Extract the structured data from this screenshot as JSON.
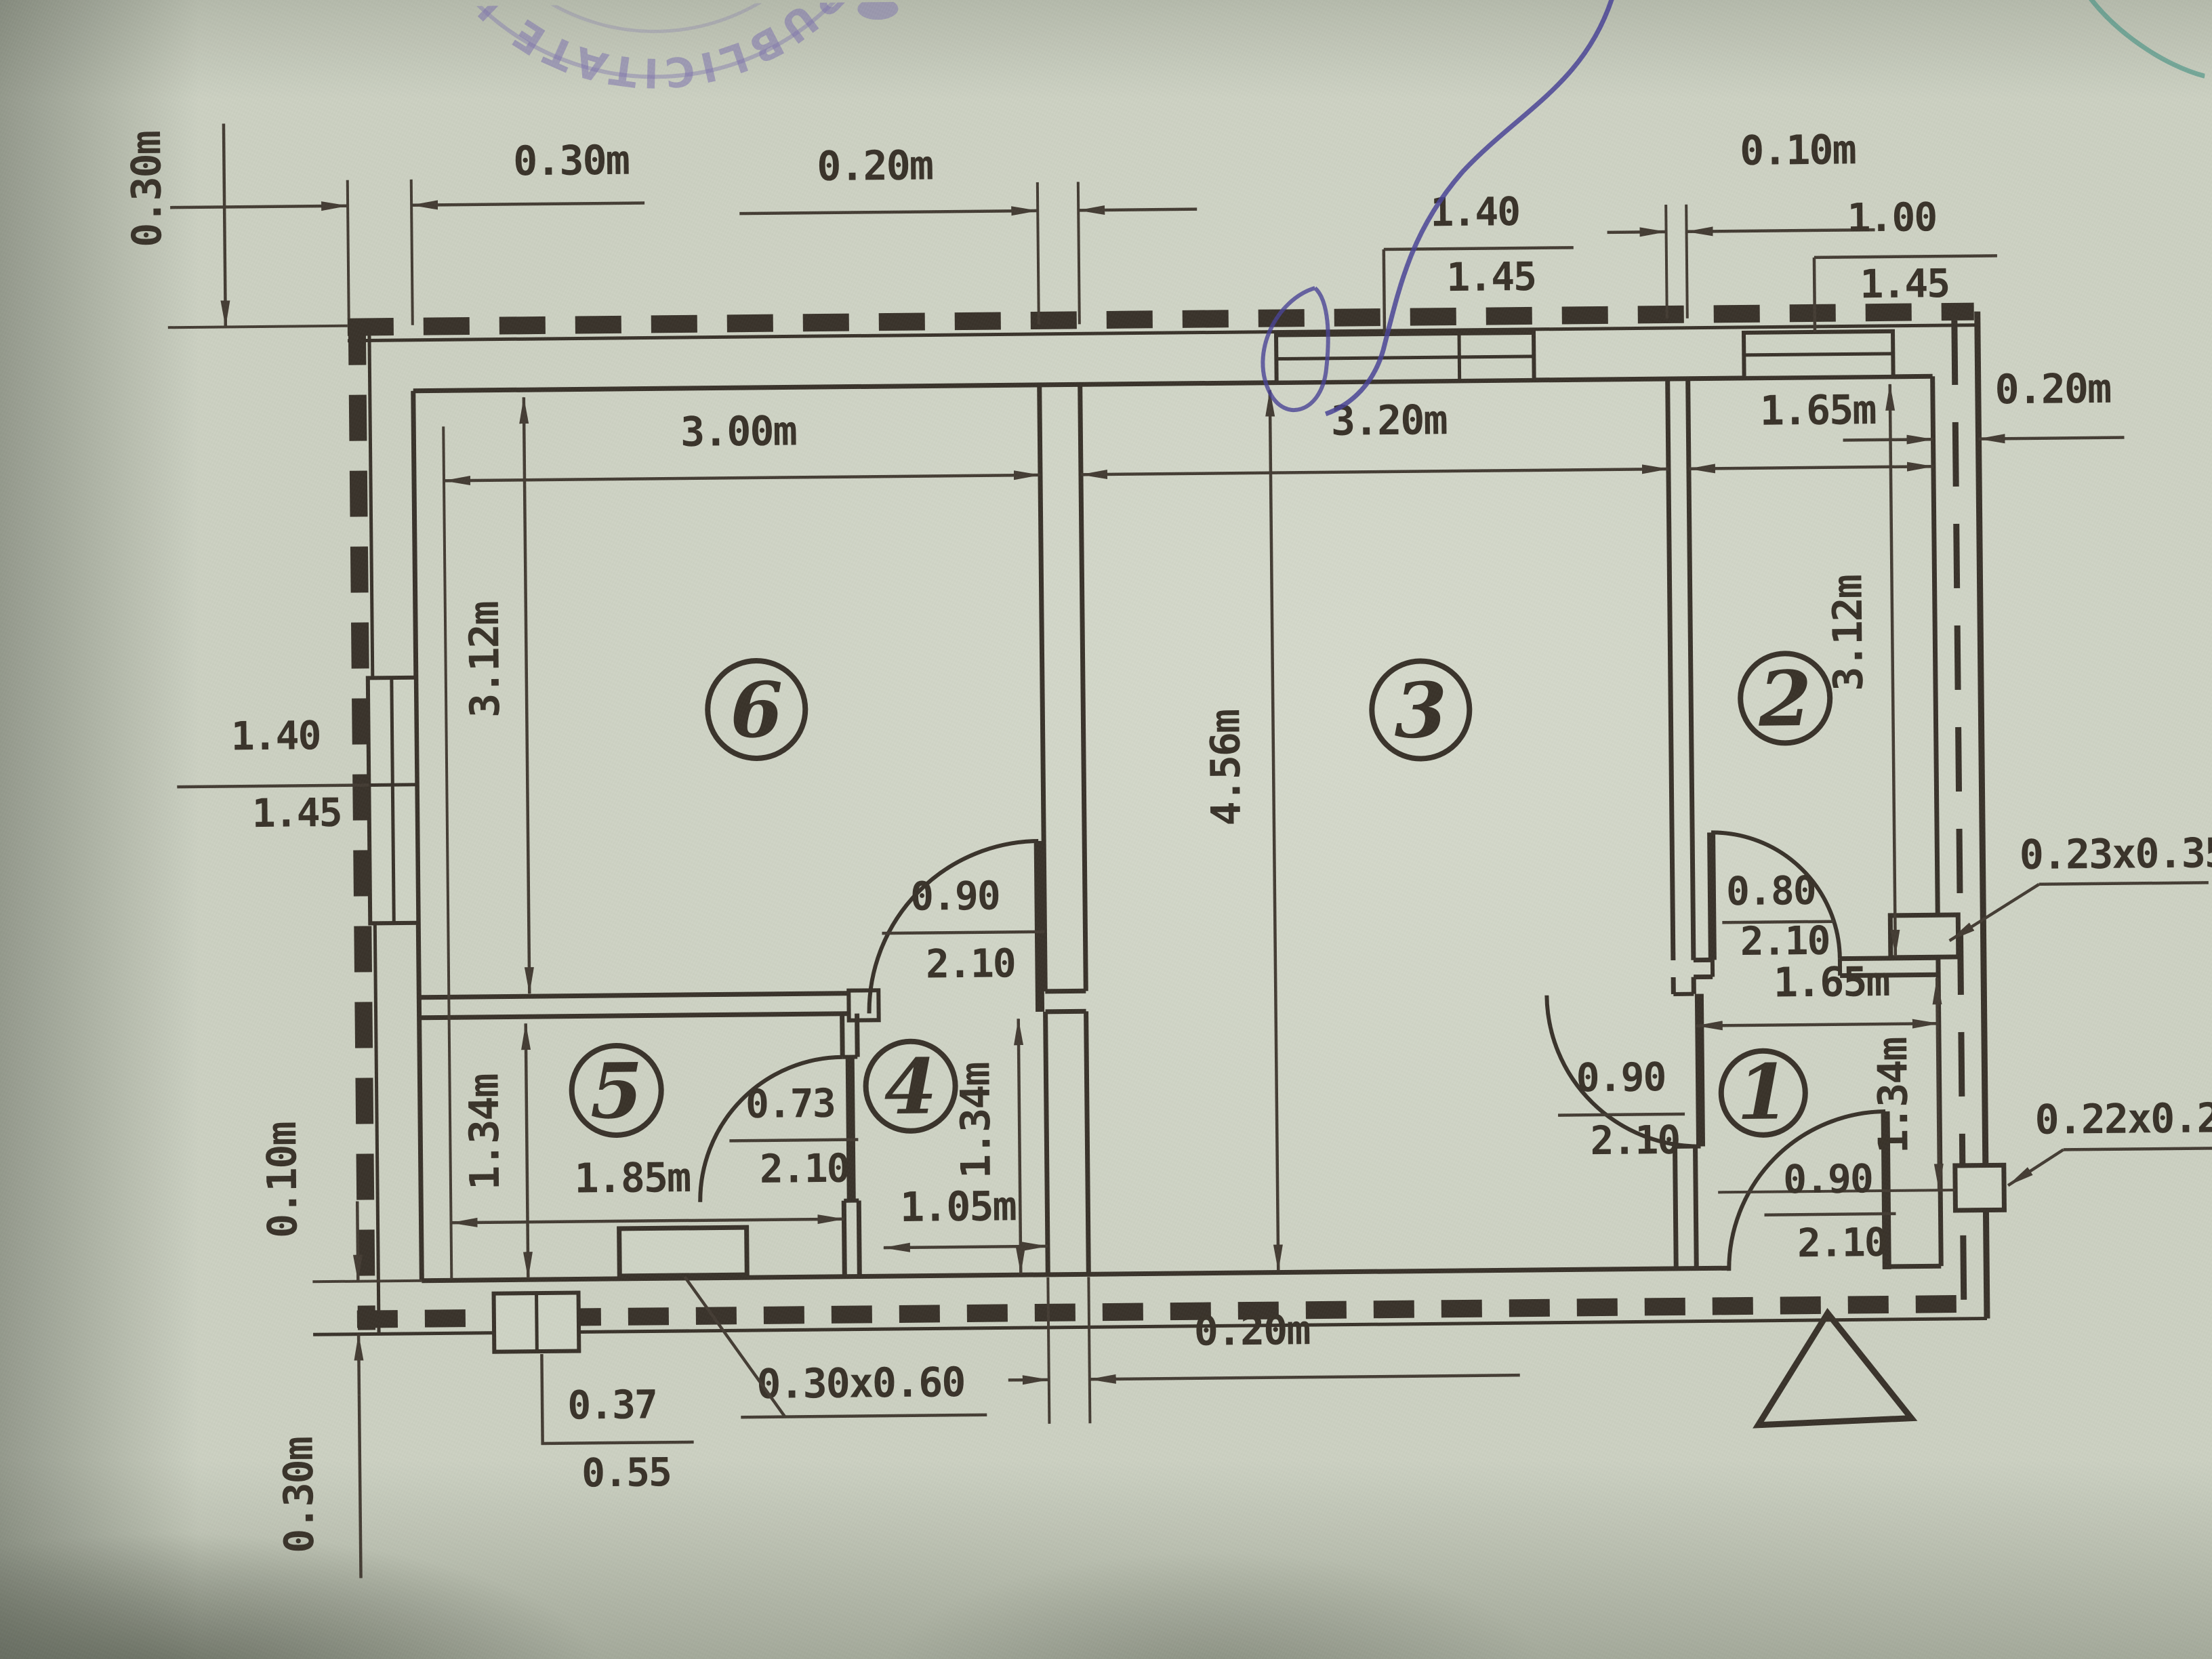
{
  "colors": {
    "paper": "#ccd1c2",
    "ink": "#3a332b",
    "stamp_purple": "#7e74ad",
    "pen_blue": "#4a4496",
    "marker_green": "#3f9080"
  },
  "stamp": {
    "ring_text": "SI PUBLICITATE IMO"
  },
  "rooms": {
    "r1": "1",
    "r2": "2",
    "r3": "3",
    "r4": "4",
    "r5": "5",
    "r6": "6"
  },
  "dims": {
    "top_left_wall_v": "0.30m",
    "left_wall_thickness": "0.30m",
    "partition_63_top": "0.20m",
    "partition_32_top": "0.10m",
    "right_wall": "0.20m",
    "partition_bottom": "0.20m",
    "room6_width": "3.00m",
    "room6_height": "3.12m",
    "room3_width": "3.20m",
    "room3_height": "4.56m",
    "room2_width": "1.65m",
    "room2_height": "3.12m",
    "room1_width": "1.65m",
    "room1_height": "1.34m",
    "room5_width": "1.85m",
    "room5_height": "1.34m",
    "room4_width": "1.05m",
    "room4_height": "1.34m",
    "bottom_wall_inner": "0.10m",
    "bottom_wall_outer": "0.30m"
  },
  "windows": {
    "left": {
      "num": "1.40",
      "den": "1.45"
    },
    "top_room3": {
      "num": "1.40",
      "den": "1.45"
    },
    "top_room2": {
      "num": "1.00",
      "den": "1.45"
    },
    "bottom_room5": {
      "num": "0.37",
      "den": "0.55"
    }
  },
  "doors": {
    "room6_room4": {
      "num": "0.90",
      "den": "2.10"
    },
    "room5_room4": {
      "num": "0.73",
      "den": "2.10"
    },
    "room2": {
      "num": "0.80",
      "den": "2.10"
    },
    "hall_room1": {
      "num": "0.90",
      "den": "2.10"
    },
    "entrance": {
      "num": "0.90",
      "den": "2.10"
    }
  },
  "annotations": {
    "flue_small": "0.23x0.35",
    "flue_tiny": "0.22x0.22",
    "stove": "0.30x0.60"
  }
}
